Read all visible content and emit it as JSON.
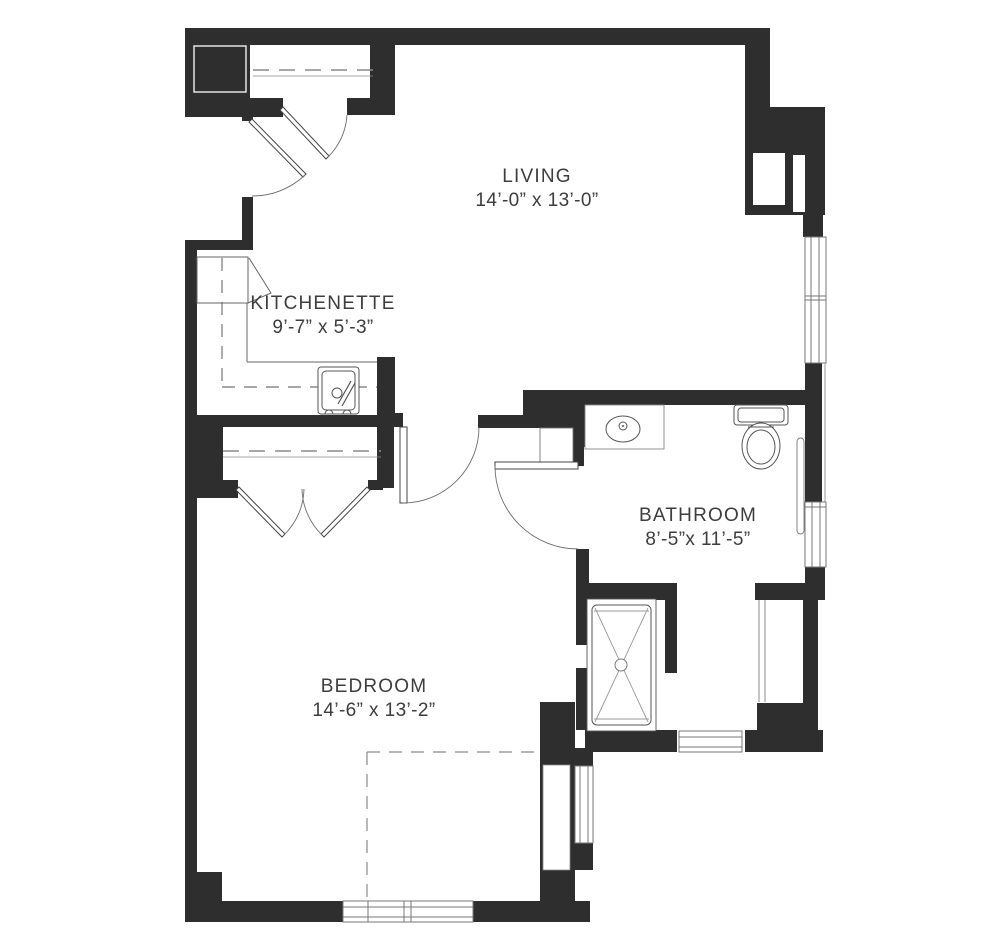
{
  "document": {
    "type": "apartment-floor-plan",
    "background": "#ffffff"
  },
  "rooms": [
    {
      "id": "living",
      "name": "LIVING",
      "dims": "14’-0” x 13’-0”"
    },
    {
      "id": "kitchenette",
      "name": "KITCHENETTE",
      "dims": "9’-7” x 5’-3”"
    },
    {
      "id": "bathroom",
      "name": "BATHROOM",
      "dims": "8’-5”x 11’-5”"
    },
    {
      "id": "bedroom",
      "name": "BEDROOM",
      "dims": "14’-6” x 13’-2”"
    }
  ],
  "fixtures": [
    "entry-double-doors",
    "coat-closet-rod",
    "refrigerator",
    "kitchen-sink",
    "bedroom-closet-double-doors",
    "bedroom-closet-rod",
    "vanity-sink",
    "toilet",
    "shower-pan",
    "grab-bar",
    "windows",
    "dashed-furniture-outline"
  ],
  "colors": {
    "wall": "#2e2e2e",
    "line": "#6e6e6e",
    "fixture-line": "#555555",
    "text": "#3d3d3d",
    "background": "#ffffff"
  }
}
